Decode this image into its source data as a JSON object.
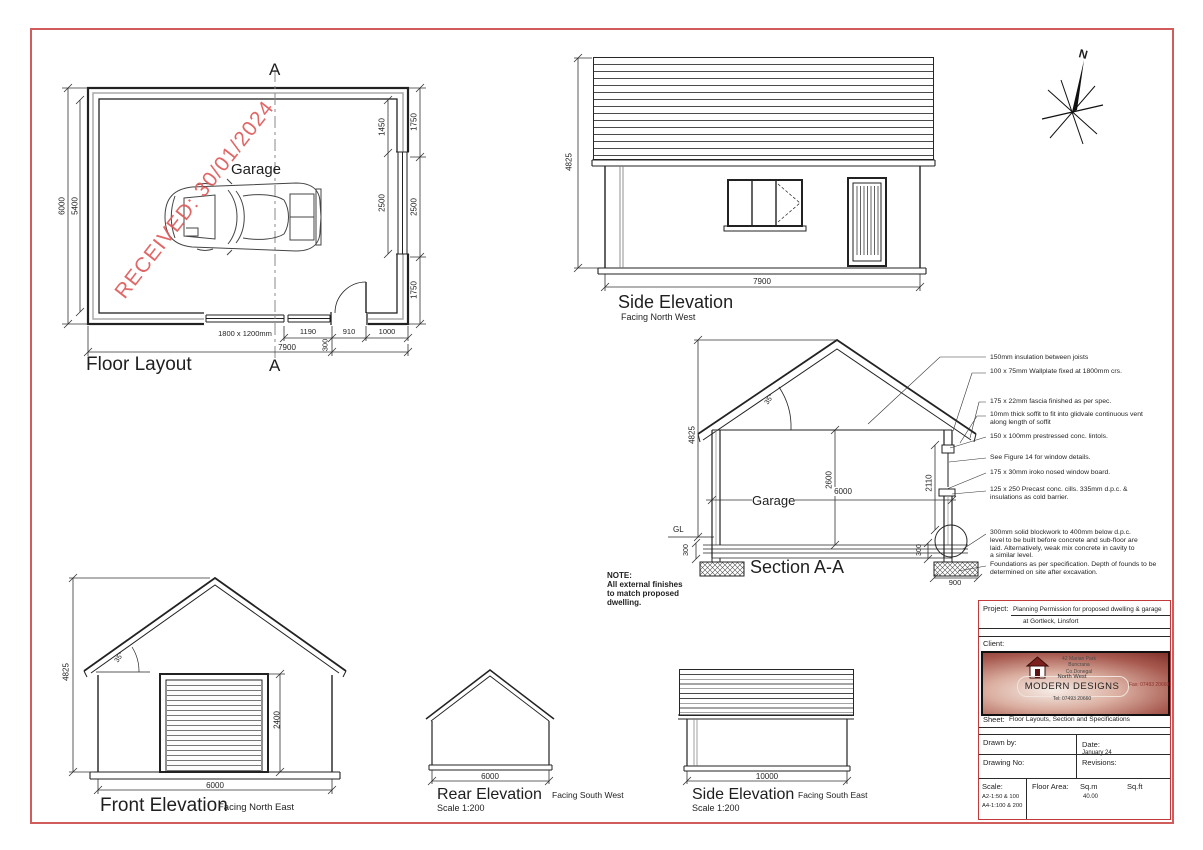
{
  "drawing": {
    "stamp": "RECEIVED: 30/01/2024",
    "north_label": "N"
  },
  "floor_layout": {
    "title": "Floor Layout",
    "room_label": "Garage",
    "section_marker": "A",
    "dim_left_outer": "6000",
    "dim_left_inner": "5400",
    "dim_right_inner_top": "1450",
    "dim_right_inner_mid": "2500",
    "dim_right_outer_top": "1750",
    "dim_right_outer_mid": "2500",
    "dim_right_outer_bottom": "1750",
    "window_label": "1800 x 1200mm",
    "dim_bottom_1": "1190",
    "dim_bottom_2": "910",
    "dim_bottom_3": "1000",
    "dim_door_offset": "300",
    "dim_bottom_overall": "7900"
  },
  "side_elevation_nw": {
    "title": "Side Elevation",
    "subtitle": "Facing North West",
    "dim_height": "4825",
    "dim_width": "7900"
  },
  "section_aa": {
    "title": "Section A-A",
    "room_label": "Garage",
    "ground_label": "GL",
    "roof_angle": "35°",
    "dim_height": "4825",
    "dim_internal_height": "2600",
    "dim_internal_width": "6000",
    "dim_opening_height": "2110",
    "dim_found_left": "300",
    "dim_found_right": "300",
    "dim_found_width": "900",
    "note_title": "NOTE:",
    "note_body": "All external finishes to match proposed dwelling.",
    "annotations": [
      "150mm insulation between joists",
      "100 x 75mm Wallplate fixed at 1800mm crs.",
      "175 x 22mm fascia finished as per spec.",
      "10mm thick soffit to fit into glidvale continuous vent along length of soffit",
      "150 x 100mm prestressed  conc. lintols.",
      "See Figure 14 for window details.",
      "175 x 30mm iroko nosed window board.",
      "125 x 250 Precast conc. cills. 335mm d.p.c. & insulations as cold barrier.",
      "300mm solid blockwork to 400mm below d.p.c. level to be built before concrete and sub-floor are laid. Alternatively, weak mix concrete in cavity to a similar level.",
      "Foundations as per specification. Depth of founds to be determined on site after excavation."
    ]
  },
  "front_elevation": {
    "title": "Front Elevation",
    "subtitle": "Facing North East",
    "roof_angle": "35°",
    "dim_height": "4825",
    "dim_door_height": "2400",
    "dim_width": "6000"
  },
  "rear_elevation": {
    "title": "Rear Elevation",
    "subtitle": "Facing South West",
    "scale": "Scale 1:200",
    "dim_width": "6000"
  },
  "side_elevation_se": {
    "title": "Side Elevation",
    "subtitle": "Facing South East",
    "scale": "Scale 1:200",
    "dim_width": "10000"
  },
  "title_block": {
    "project_label": "Project:",
    "project_line1": "Planning Permission for proposed dwelling & garage",
    "project_line2": "at Gortleck, Linsfort",
    "client_label": "Client:",
    "logo": {
      "address1": "42 Marian Park",
      "address2": "Buncrana",
      "address3": "Co.Donegal",
      "name_line1": "North West",
      "name_line2": "MODERN DESIGNS",
      "tel": "Tel: 07493 20660",
      "fax": "Fax: 07493 20660"
    },
    "sheet_label": "Sheet:",
    "sheet_value": "Floor Layouts, Section and Specifications",
    "drawn_by_label": "Drawn by:",
    "date_label": "Date:",
    "date_value": "January 24",
    "drawing_no_label": "Drawing No:",
    "revisions_label": "Revisions:",
    "scale_label": "Scale:",
    "scale_line1": "A2-1:50 & 100",
    "scale_line2": "A4-1:100 & 200",
    "floor_area_label": "Floor Area:",
    "sqm_label": "Sq.m",
    "sqm_value": "40.00",
    "sqft_label": "Sq.ft"
  }
}
